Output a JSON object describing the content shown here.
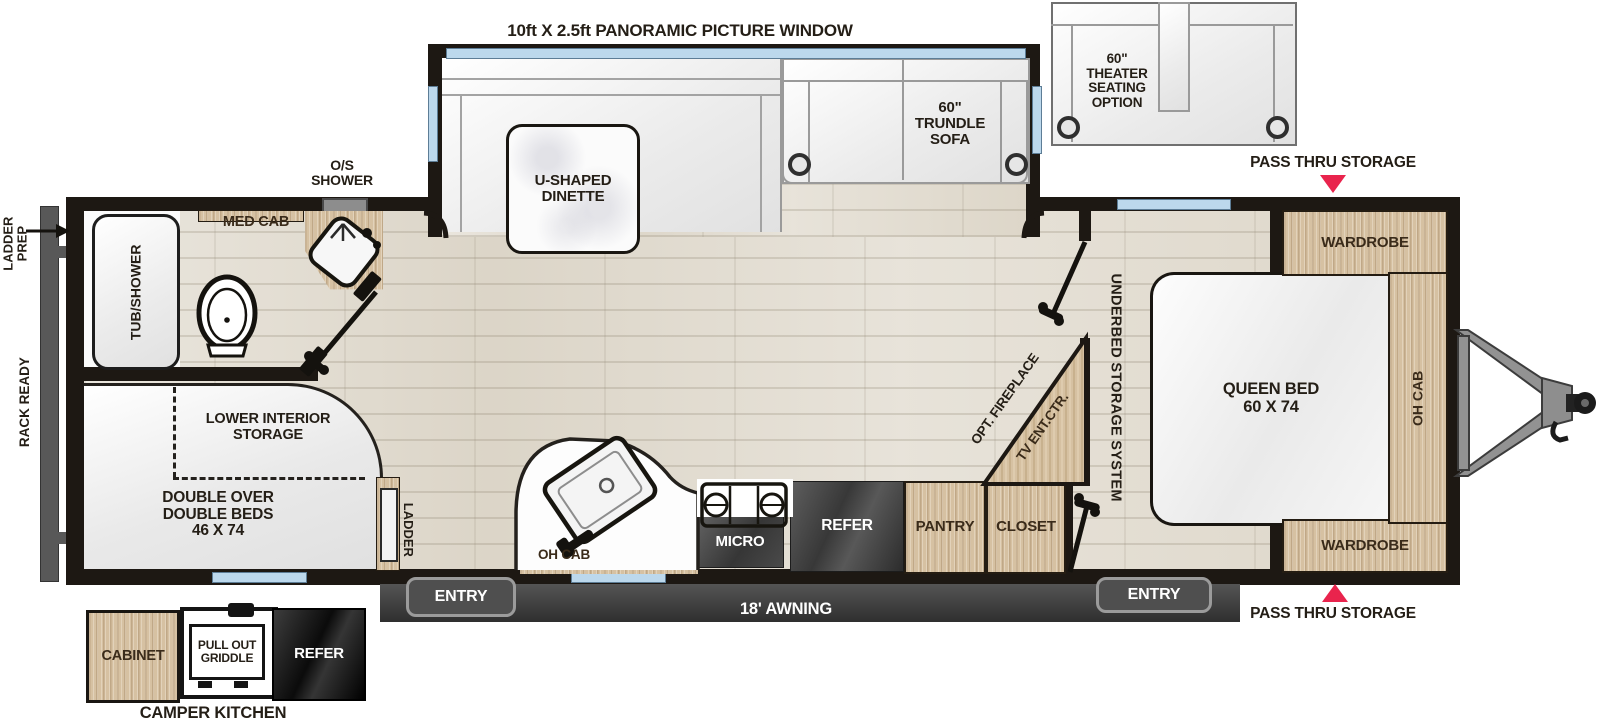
{
  "colors": {
    "accent_red": "#e9244d",
    "wall": "#1d1813",
    "wood": "#d6c1a2",
    "floor": "#e1dbcf",
    "window_blue": "#bcd8ec",
    "appliance_dark": "#3f3f3f"
  },
  "exterior": {
    "panoramic_window": "10ft X 2.5ft PANORAMIC PICTURE WINDOW",
    "pass_thru_top": "PASS THRU STORAGE",
    "pass_thru_bottom": "PASS THRU STORAGE",
    "ladder_prep": "LADDER\nPREP",
    "rack_ready": "RACK READY",
    "awning": "18' AWNING",
    "entry_left": "ENTRY",
    "entry_right": "ENTRY"
  },
  "slideout": {
    "dinette": "U-SHAPED\nDINETTE",
    "trundle_sofa": "60\"\nTRUNDLE\nSOFA",
    "theater_seating": "60\"\nTHEATER\nSEATING\nOPTION"
  },
  "bathroom": {
    "os_shower": "O/S\nSHOWER",
    "med_cab": "MED CAB",
    "tub_shower": "TUB/SHOWER"
  },
  "rear": {
    "lower_interior_storage": "LOWER INTERIOR\nSTORAGE",
    "double_beds": "DOUBLE OVER\nDOUBLE BEDS\n46 X 74",
    "ladder": "LADDER"
  },
  "kitchen": {
    "oh_cab": "OH CAB",
    "micro": "MICRO",
    "refer": "REFER",
    "pantry": "PANTRY",
    "closet": "CLOSET",
    "opt_fireplace": "OPT. FIREPLACE",
    "tv_ent_ctr": "TV ENT.CTR."
  },
  "bedroom": {
    "underbed": "UNDERBED STORAGE SYSTEM",
    "queen_bed": "QUEEN BED\n60 X 74",
    "wardrobe_top": "WARDROBE",
    "wardrobe_bottom": "WARDROBE",
    "oh_cab": "OH CAB"
  },
  "camper_kitchen": {
    "title": "CAMPER KITCHEN",
    "cabinet": "CABINET",
    "griddle": "PULL OUT\nGRIDDLE",
    "refer": "REFER"
  }
}
